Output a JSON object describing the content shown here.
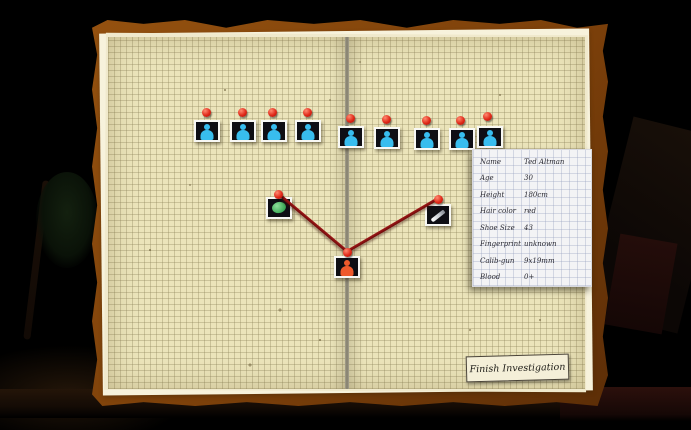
{
  "scene": {
    "type": "detective-evidence-notebook",
    "palette": {
      "cover": "#7c400a",
      "page": "#ebe4ba",
      "yarn": "#7c0f0f",
      "pin": "#e02818",
      "suspect_icon_color": "#38bdee",
      "victim_icon_color": "#ef5a2c",
      "evidence_green": "#3aa855"
    }
  },
  "board": {
    "suspects": [
      {
        "icon": "suspect-person-icon"
      },
      {
        "icon": "suspect-person-icon"
      },
      {
        "icon": "suspect-person-icon"
      },
      {
        "icon": "suspect-person-icon"
      },
      {
        "icon": "suspect-person-icon"
      },
      {
        "icon": "suspect-person-icon"
      },
      {
        "icon": "suspect-person-icon"
      },
      {
        "icon": "suspect-person-icon"
      },
      {
        "icon": "suspect-person-icon"
      }
    ],
    "evidence": [
      {
        "icon": "green-object-icon"
      },
      {
        "icon": "knife-icon"
      }
    ],
    "victim": {
      "icon": "victim-person-icon"
    },
    "connections": [
      {
        "from": "green-object-photo",
        "to": "victim-photo"
      },
      {
        "from": "knife-photo",
        "to": "victim-photo"
      }
    ]
  },
  "info_card": {
    "rows": [
      {
        "label": "Name",
        "value": "Ted Altman"
      },
      {
        "label": "Age",
        "value": "30"
      },
      {
        "label": "Height",
        "value": "180cm"
      },
      {
        "label": "Hair color",
        "value": "red"
      },
      {
        "label": "Shoe Size",
        "value": "43"
      },
      {
        "label": "Fingerprint",
        "value": "unknown"
      },
      {
        "label": "Calib-gun",
        "value": "9x19mm"
      },
      {
        "label": "Blood",
        "value": "0+"
      }
    ]
  },
  "finish_button": {
    "label": "Finish Investigation"
  }
}
